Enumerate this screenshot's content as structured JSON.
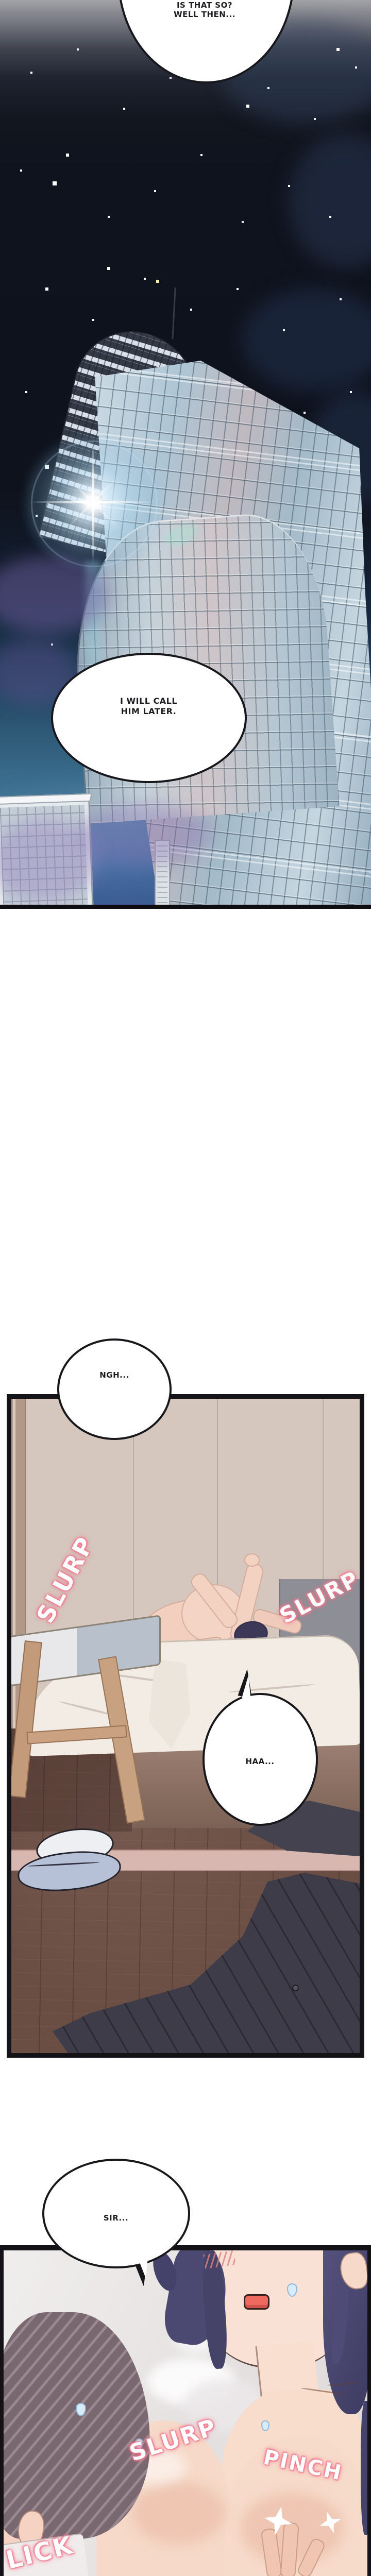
{
  "panel1": {
    "bubble_top": {
      "line1": "IS THAT SO?",
      "line2": "WELL THEN..."
    },
    "bubble_call": {
      "line1": "I WILL CALL",
      "line2": "HIM LATER."
    }
  },
  "gap": {
    "bubble_ngh": "NGH..."
  },
  "panel2": {
    "sfx_slurp_left": "SLURP",
    "sfx_slurp_right": "SLURP",
    "bubble_haa": "HAA..."
  },
  "panel3": {
    "bubble_sir": "SIR...",
    "sfx_slurp": "SLURP",
    "sfx_pinch": "PINCH",
    "sfx_lick": "LICK"
  },
  "colors": {
    "sfx_glow": "#f2798f",
    "night_sky": "#10141e",
    "wall_beige": "#d5c7be",
    "floor_brown": "#6a4d43",
    "hair_blue": "#4b4972",
    "skin": "#f7dbca",
    "panel_border": "#121217"
  }
}
